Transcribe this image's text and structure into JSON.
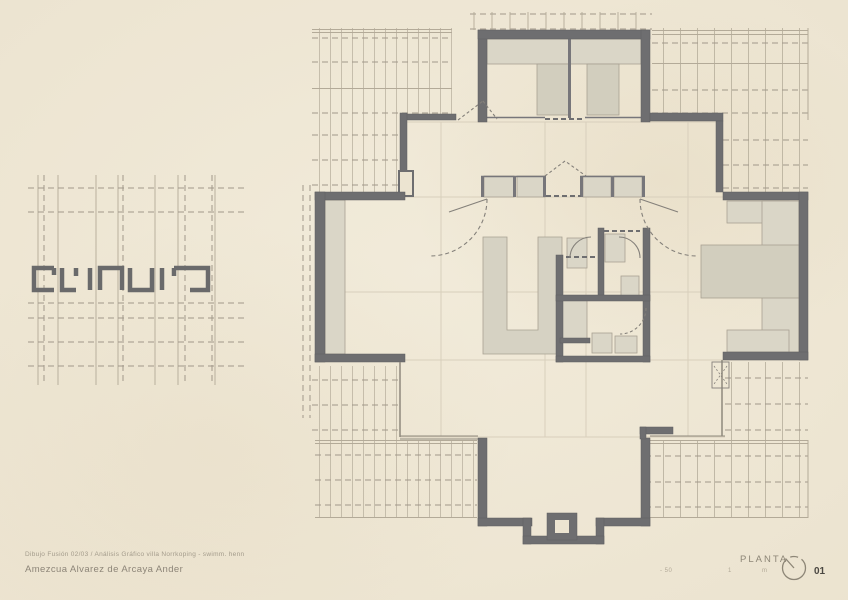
{
  "colors": {
    "paper": "#ece4d1",
    "wall": "#6e6e70",
    "light_fill": "#dad6c7",
    "light_fill_dark": "#d2cebe",
    "hatch_line": "#b3aa98",
    "dash_line": "#a1988a",
    "grid_line": "#d8cfbc",
    "faint_ink": "#8d8677",
    "sheet_ink": "#4a4741"
  },
  "titleblock": {
    "project_line": "Dibujo Fusión 02/03 / Análisis Gráfico villa Norrkoping - swimm. henn",
    "author_line": "Amezcua Alvarez de Arcaya Ander"
  },
  "footer": {
    "drawing_label": "PLANTA",
    "sheet_number": "01",
    "scale_marks": [
      "- 50",
      "1",
      "m"
    ]
  },
  "icons": {
    "north_arrow": "north-arrow-icon"
  }
}
